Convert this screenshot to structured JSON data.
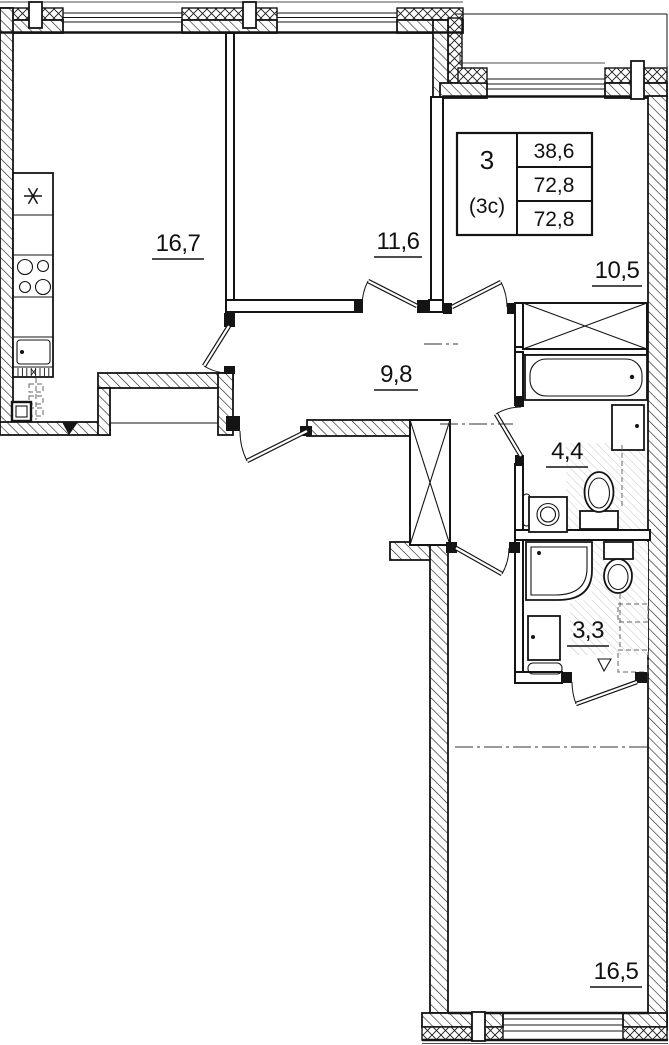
{
  "drawing": {
    "type": "apartment-floor-plan",
    "unit_stamp": {
      "rooms": "3",
      "layout_type": "(3c)",
      "living_area": "38,6",
      "area": "72,8",
      "total_area": "72,8"
    },
    "rooms": [
      {
        "name": "kitchen-living-room",
        "area": "16,7"
      },
      {
        "name": "bedroom-1",
        "area": "11,6"
      },
      {
        "name": "bedroom-2",
        "area": "10,5"
      },
      {
        "name": "hallway",
        "area": "9,8"
      },
      {
        "name": "bathroom",
        "area": "4,4"
      },
      {
        "name": "shower-room",
        "area": "3,3"
      },
      {
        "name": "bedroom-3",
        "area": "16,5"
      }
    ],
    "colors": {
      "walls": "#141414",
      "background": "#ffffff",
      "wet_zone_hatch": "#c6c6c6"
    },
    "symbols": {
      "stove": "asterisk",
      "closet": "x-cross",
      "floor_drain": "triangle"
    }
  }
}
